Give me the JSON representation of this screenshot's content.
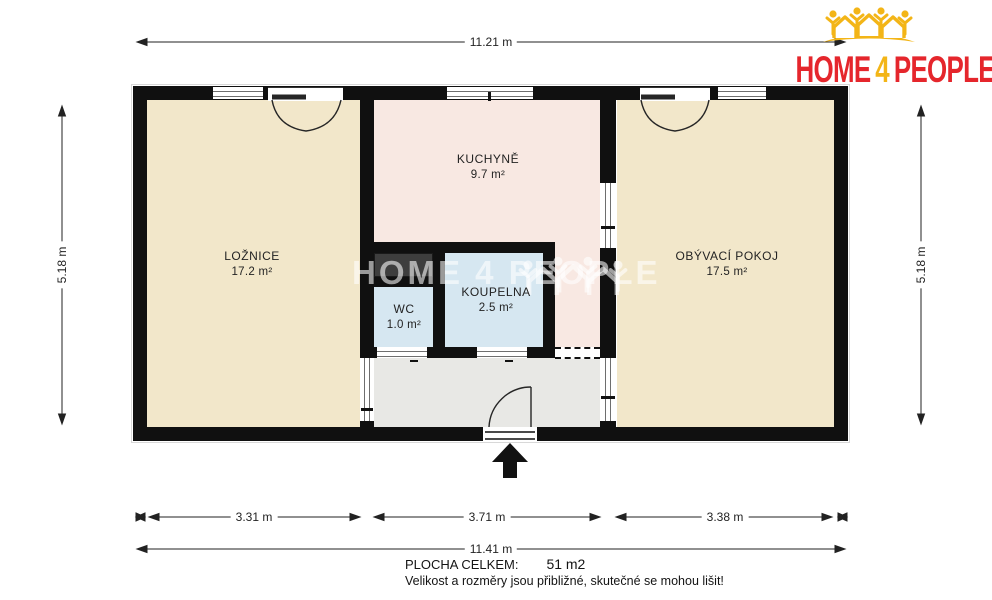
{
  "logo": {
    "home": "HOME",
    "four": "4",
    "people": "PEOPLE"
  },
  "watermark": {
    "text": "HOME 4 PEOPLE"
  },
  "dimensions": {
    "top": "11.21 m",
    "left": "5.18 m",
    "right": "5.18 m",
    "bottom_segments": [
      "3.31 m",
      "3.71 m",
      "3.38 m"
    ],
    "bottom_total": "11.41 m"
  },
  "rooms": {
    "bedroom": {
      "name": "LOŽNICE",
      "area": "17.2 m²"
    },
    "kitchen": {
      "name": "KUCHYNĚ",
      "area": "9.7 m²"
    },
    "living": {
      "name": "OBÝVACÍ POKOJ",
      "area": "17.5 m²"
    },
    "bathroom": {
      "name": "KOUPELNA",
      "area": "2.5 m²"
    },
    "wc": {
      "name": "WC",
      "area": "1.0 m²"
    }
  },
  "summary": {
    "label": "PLOCHA CELKEM:",
    "value": "51 m2",
    "note": "Velikost a rozměry jsou přibližné, skutečné se mohou lišit!"
  },
  "colors": {
    "wall": "#101010",
    "room_beige": "#F2E7CA",
    "room_pink": "#F8E8E2",
    "room_blue": "#D6E7F1",
    "hall_gray": "#E8E8E5",
    "wardrobe_gray": "#3E3E3E",
    "logo_red": "#E5262C",
    "logo_yellow": "#F3B517",
    "dim_color": "#222222"
  }
}
